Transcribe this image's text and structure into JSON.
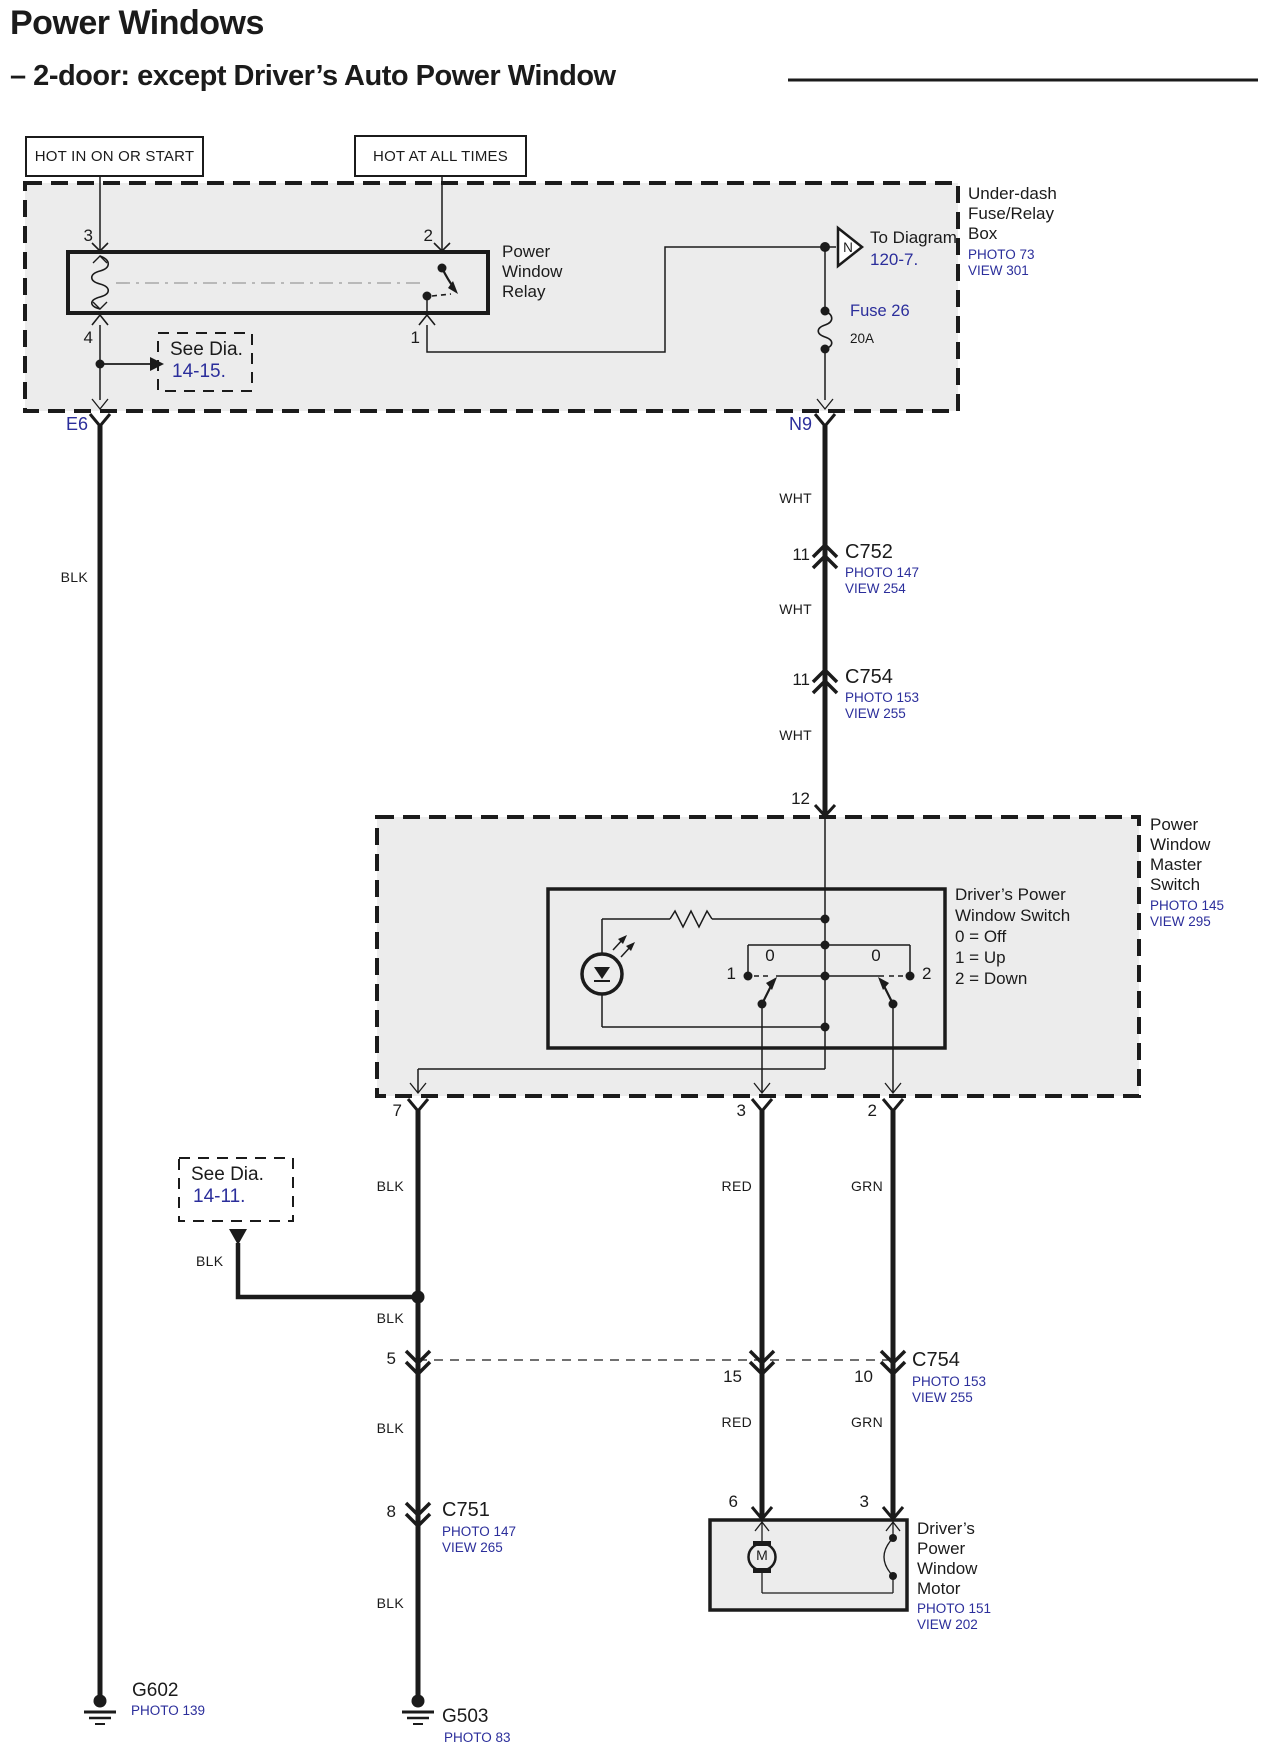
{
  "colors": {
    "link_blue": "#2b2e9b",
    "diagram_ink": "#1b1b1b",
    "panel_gray": "#ececec"
  },
  "header": {
    "title": "Power Windows",
    "subtitle": "– 2-door: except Driver’s Auto Power Window"
  },
  "power_sources": {
    "ignition": "HOT IN ON OR START",
    "battery": "HOT AT ALL TIMES"
  },
  "underdash_box": {
    "line1": "Under-dash",
    "line2": "Fuse/Relay",
    "line3": "Box",
    "photo": "PHOTO 73",
    "view": "VIEW 301"
  },
  "relay": {
    "line1": "Power",
    "line2": "Window",
    "line3": "Relay",
    "pin_top_left": "3",
    "pin_top_right": "2",
    "pin_bottom_left": "4",
    "pin_bottom_right": "1"
  },
  "to_diagram": {
    "symbol": "N",
    "label": "To Diagram",
    "ref": "120-7."
  },
  "fuse": {
    "name": "Fuse 26",
    "rating": "20A"
  },
  "see_dia_14_15": {
    "label": "See  Dia.",
    "ref": "14-15."
  },
  "see_dia_14_11": {
    "label": "See  Dia.",
    "ref": "14-11."
  },
  "terminals": {
    "left": "E6",
    "right": "N9"
  },
  "wire_colors": {
    "wht": "WHT",
    "blk": "BLK",
    "red": "RED",
    "grn": "GRN"
  },
  "connectors": {
    "c752": {
      "pin": "11",
      "name": "C752",
      "photo": "PHOTO 147",
      "view": "VIEW 254"
    },
    "c754_upper": {
      "pin": "11",
      "name": "C754",
      "photo": "PHOTO 153",
      "view": "VIEW 255"
    },
    "c754_lower": {
      "pin_blk": "5",
      "pin_red": "15",
      "pin_grn": "10",
      "name": "C754",
      "photo": "PHOTO 153",
      "view": "VIEW 255"
    },
    "c751": {
      "pin": "8",
      "name": "C751",
      "photo": "PHOTO 147",
      "view": "VIEW 265"
    }
  },
  "master_switch": {
    "pin_in": "12",
    "line1": "Power",
    "line2": "Window",
    "line3": "Master",
    "line4": "Switch",
    "photo": "PHOTO 145",
    "view": "VIEW 295",
    "pin_out_blk": "7",
    "pin_out_red": "3",
    "pin_out_grn": "2",
    "legend": {
      "line1": "Driver’s Power",
      "line2": "Window Switch",
      "off": "0 = Off",
      "up": "1 = Up",
      "down": "2 = Down"
    },
    "positions": {
      "left_1": "1",
      "left_0": "0",
      "right_0": "0",
      "right_2": "2"
    }
  },
  "motor": {
    "pin_red": "6",
    "pin_grn": "3",
    "symbol": "M",
    "line1": "Driver’s",
    "line2": "Power",
    "line3": "Window",
    "line4": "Motor",
    "photo": "PHOTO 151",
    "view": "VIEW 202"
  },
  "grounds": {
    "g602": {
      "name": "G602",
      "photo": "PHOTO 139"
    },
    "g503": {
      "name": "G503",
      "photo": "PHOTO 83"
    }
  }
}
